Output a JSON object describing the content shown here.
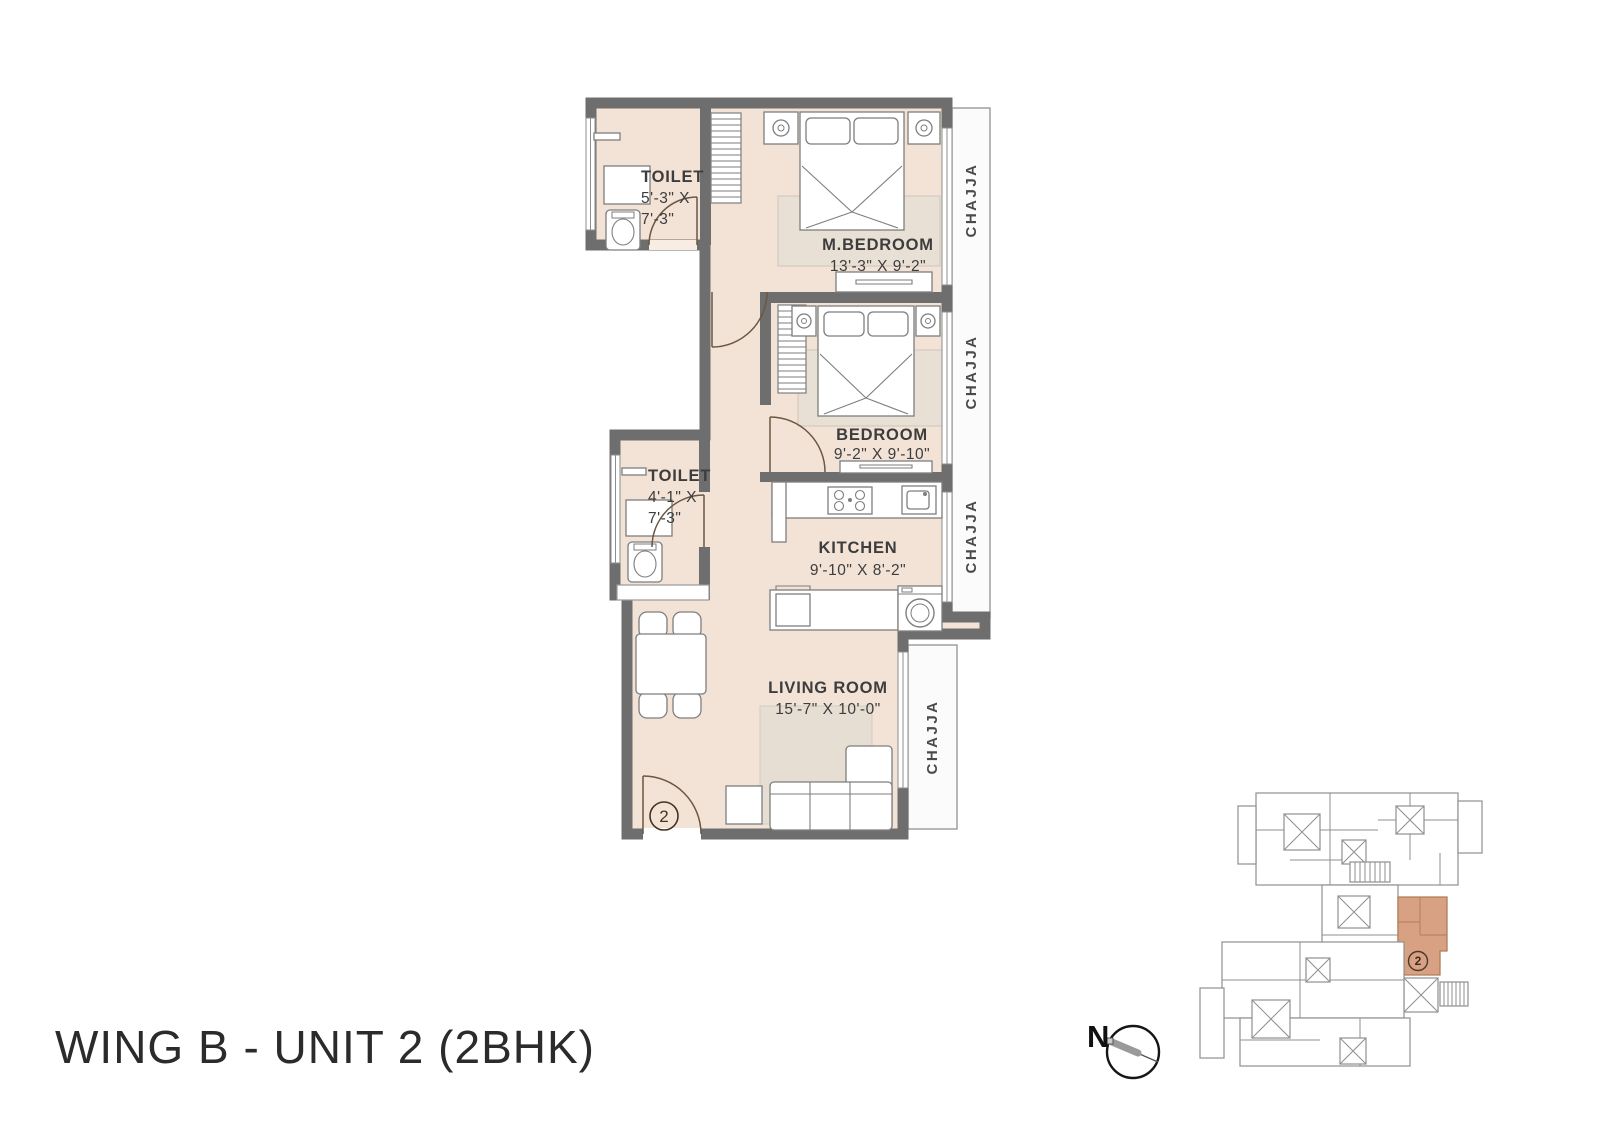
{
  "title": "WING B - UNIT 2 (2BHK)",
  "plan": {
    "unit_marker": "2",
    "chajja_label": "CHAJJA",
    "rooms": {
      "toilet_top": {
        "name": "TOILET",
        "dim_line1": "5'-3\" X",
        "dim_line2": "7'-3\""
      },
      "master_bedroom": {
        "name": "M.BEDROOM",
        "dims": "13'-3\" X 9'-2\""
      },
      "bedroom": {
        "name": "BEDROOM",
        "dims": "9'-2\" X 9'-10\""
      },
      "toilet_mid": {
        "name": "TOILET",
        "dim_line1": "4'-1\" X",
        "dim_line2": "7'-3\""
      },
      "kitchen": {
        "name": "KITCHEN",
        "dims": "9'-10\" X 8'-2\""
      },
      "living_room": {
        "name": "LIVING ROOM",
        "dims": "15'-7\" X 10'-0\""
      }
    }
  },
  "key_plan": {
    "highlighted_unit_marker": "2"
  },
  "compass": {
    "north_label": "N"
  },
  "colors": {
    "floor": "#f2e3d6",
    "wall": "#6e6e6e",
    "chajja": "#fbfbfb",
    "rug": "#e9e0d5",
    "highlight": "#d9a183",
    "text": "#3d3d3d"
  }
}
